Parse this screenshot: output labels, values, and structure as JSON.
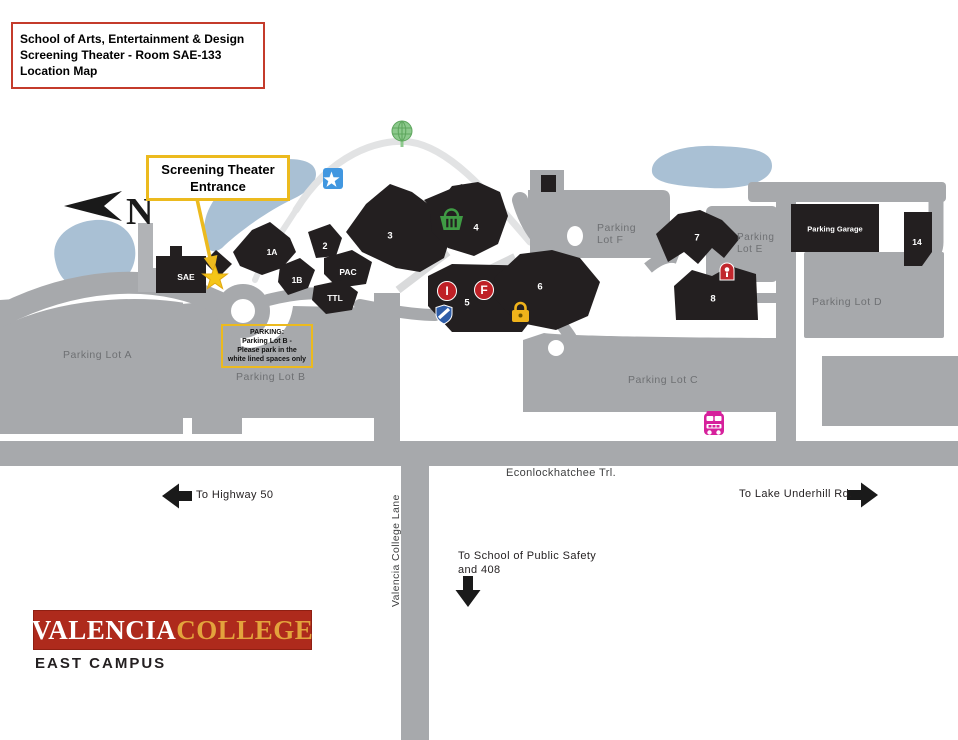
{
  "title_box": {
    "line1": "School of Arts, Entertainment & Design",
    "line2": "Screening Theater - Room SAE-133",
    "line3": "Location Map"
  },
  "entrance_callout": {
    "line1": "Screening Theater",
    "line2": "Entrance"
  },
  "parking_callout": {
    "line1": "PARKING:",
    "line2": "Parking Lot B -",
    "line3": "Please park in the",
    "line4": "white lined spaces only"
  },
  "compass": {
    "north_label": "N"
  },
  "buildings": {
    "sae": "SAE",
    "b1a": "1A",
    "b1b": "1B",
    "b2": "2",
    "b3": "3",
    "b4": "4",
    "b5": "5",
    "b6": "6",
    "b7": "7",
    "b8": "8",
    "b14": "14",
    "pac": "PAC",
    "ttl": "TTL",
    "parking_garage": "Parking Garage"
  },
  "building_icons": {
    "info_letter": "I",
    "f_letter": "F"
  },
  "parking_lots": {
    "lot_a": "Parking Lot A",
    "lot_b": "Parking Lot B",
    "lot_c": "Parking Lot C",
    "lot_d": "Parking Lot D",
    "lot_e_line1": "Parking",
    "lot_e_line2": "Lot E",
    "lot_f_line1": "Parking",
    "lot_f_line2": "Lot F"
  },
  "streets": {
    "econlockhatchee": "Econlockhatchee Trl.",
    "valencia_college_lane": "Valencia College Lane"
  },
  "directions": {
    "highway": "To Highway 50",
    "lake_underhill": "To Lake Underhill Rd.",
    "public_safety_line1": "To School of Public Safety",
    "public_safety_line2": "and 408"
  },
  "logo": {
    "name_part1": "VALENCIA",
    "name_part2": "COLLEGE",
    "campus": "EAST CAMPUS"
  },
  "icons": {
    "north-arrow-icon": "black dart + N",
    "entrance-star-icon": "yellow ★",
    "campus-star-tile-icon": "white ★ on blue tile",
    "tree-globe-icon": "green gridded globe",
    "basket-icon": "green basket",
    "information-badge-icon": "red circle with I",
    "f-badge-icon": "red circle with F",
    "shield-stripe-icon": "blue shield with white stripe",
    "padlock-icon": "yellow padlock",
    "security-badge-icon": "red badge",
    "bus-stop-icon": "magenta bus",
    "arrow-left-icon": "◀",
    "arrow-right-icon": "▶",
    "arrow-down-icon": "▼"
  },
  "colors": {
    "building": "#231f20",
    "road": "#a7a9ac",
    "pond": "#a9c0d4",
    "label_gray": "#6e7073",
    "accent_yellow": "#ecba1e",
    "callout_red_border": "#c43b2b",
    "valencia_red": "#ae2a1c",
    "valencia_gold": "#e3a33c",
    "bus_magenta": "#d6219c",
    "icon_red": "#bf2026",
    "icon_blue": "#2e5da8",
    "icon_green": "#3f9b44",
    "star_tile_blue": "#4197e0"
  }
}
